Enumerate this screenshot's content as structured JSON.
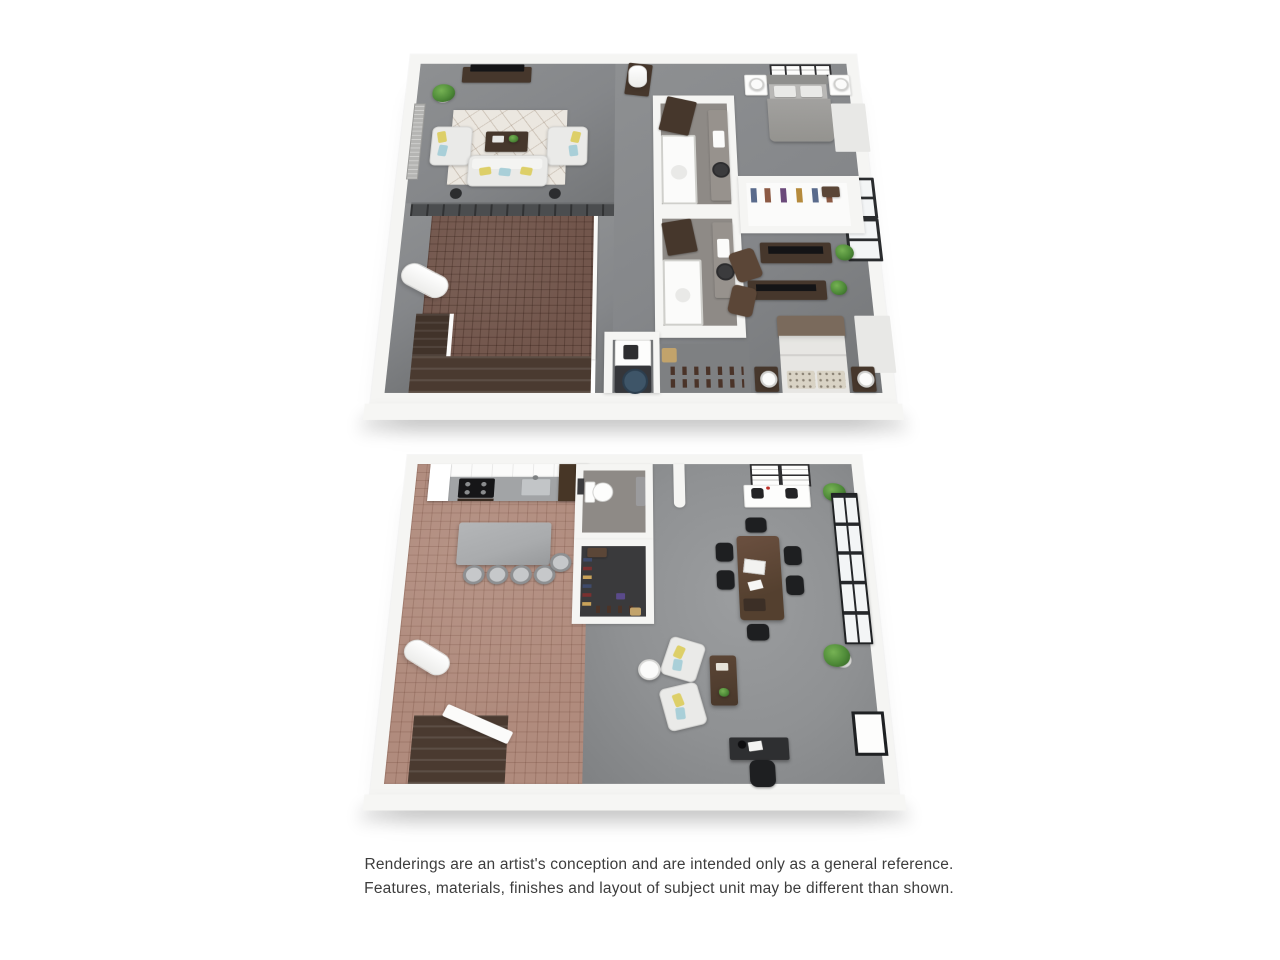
{
  "page": {
    "background": "#ffffff"
  },
  "disclaimer": {
    "line1": "Renderings are an artist's conception and are intended only as a general reference.",
    "line2": "Features, materials, finishes and layout of subject unit may be different than shown."
  },
  "floor_plans": {
    "upper": {
      "name": "upper-floor-plan",
      "rooms": [
        "living-room",
        "loft-railing-over-brick-void",
        "bathroom-1",
        "bathroom-2",
        "bedroom-1",
        "walk-in-closet",
        "bedroom-2",
        "laundry",
        "hallway",
        "stairs"
      ]
    },
    "lower": {
      "name": "lower-floor-plan",
      "rooms": [
        "kitchen",
        "island-with-stools",
        "bathroom",
        "closet",
        "office-conference-area",
        "lounge-seating",
        "desk-area",
        "stairs"
      ]
    }
  },
  "palette": {
    "wall": "#f5f5f3",
    "wall_shade": "#e3e3e1",
    "carpet": "#85878a",
    "concrete": "#8f9193",
    "brick": "#72564c",
    "brick_grout": "#59423a",
    "tile": "#b08b7d",
    "tile_grout": "#96705f",
    "wood_dark": "#46372c",
    "wood": "#5b4637",
    "stair": "#4a3a30",
    "sofa_white": "#eaeae8",
    "pillow_yellow": "#ddcf68",
    "pillow_blue": "#a9cfd8",
    "rug": "#ebe7e0",
    "plant": "#4e8a38",
    "black": "#1e1f21",
    "steel": "#b8bbbd",
    "navy": "#3e5568",
    "frame_dark": "#232527",
    "glass": "#f3f5f6",
    "text": "#3d3d3d",
    "island": "#a9abad",
    "counter": "#a2a4a6",
    "bath_floor": "#8e8a86",
    "closet_floor": "#3a3a3c",
    "tan": "#c2a36b",
    "railing": "#4b4d4f"
  }
}
